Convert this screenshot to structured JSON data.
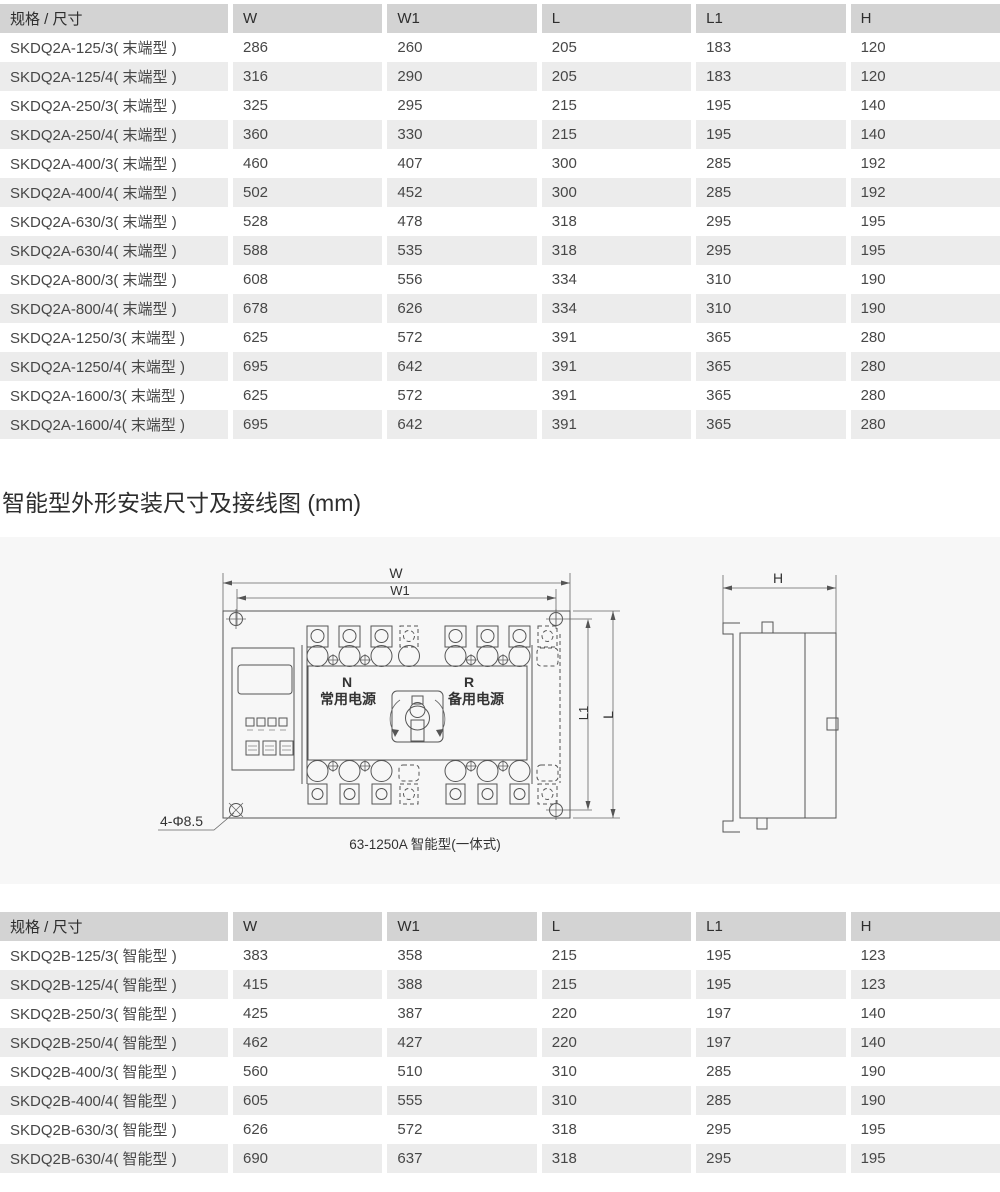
{
  "section": {
    "heading": "智能型外形安装尺寸及接线图 (mm)"
  },
  "tables": {
    "skdq2a": {
      "headers": [
        "规格 / 尺寸",
        "W",
        "W1",
        "L",
        "L1",
        "H"
      ],
      "rows": [
        [
          "SKDQ2A-125/3( 末端型 )",
          "286",
          "260",
          "205",
          "183",
          "120"
        ],
        [
          "SKDQ2A-125/4( 末端型 )",
          "316",
          "290",
          "205",
          "183",
          "120"
        ],
        [
          "SKDQ2A-250/3( 末端型 )",
          "325",
          "295",
          "215",
          "195",
          "140"
        ],
        [
          "SKDQ2A-250/4( 末端型 )",
          "360",
          "330",
          "215",
          "195",
          "140"
        ],
        [
          "SKDQ2A-400/3( 末端型 )",
          "460",
          "407",
          "300",
          "285",
          "192"
        ],
        [
          "SKDQ2A-400/4( 末端型 )",
          "502",
          "452",
          "300",
          "285",
          "192"
        ],
        [
          "SKDQ2A-630/3( 末端型 )",
          "528",
          "478",
          "318",
          "295",
          "195"
        ],
        [
          "SKDQ2A-630/4( 末端型 )",
          "588",
          "535",
          "318",
          "295",
          "195"
        ],
        [
          "SKDQ2A-800/3( 末端型 )",
          "608",
          "556",
          "334",
          "310",
          "190"
        ],
        [
          "SKDQ2A-800/4( 末端型 )",
          "678",
          "626",
          "334",
          "310",
          "190"
        ],
        [
          "SKDQ2A-1250/3( 末端型 )",
          "625",
          "572",
          "391",
          "365",
          "280"
        ],
        [
          "SKDQ2A-1250/4( 末端型 )",
          "695",
          "642",
          "391",
          "365",
          "280"
        ],
        [
          "SKDQ2A-1600/3( 末端型 )",
          "625",
          "572",
          "391",
          "365",
          "280"
        ],
        [
          "SKDQ2A-1600/4( 末端型 )",
          "695",
          "642",
          "391",
          "365",
          "280"
        ]
      ]
    },
    "skdq2b": {
      "headers": [
        "规格 / 尺寸",
        "W",
        "W1",
        "L",
        "L1",
        "H"
      ],
      "rows": [
        [
          "SKDQ2B-125/3( 智能型 )",
          "383",
          "358",
          "215",
          "195",
          "123"
        ],
        [
          "SKDQ2B-125/4( 智能型 )",
          "415",
          "388",
          "215",
          "195",
          "123"
        ],
        [
          "SKDQ2B-250/3( 智能型 )",
          "425",
          "387",
          "220",
          "197",
          "140"
        ],
        [
          "SKDQ2B-250/4( 智能型 )",
          "462",
          "427",
          "220",
          "197",
          "140"
        ],
        [
          "SKDQ2B-400/3( 智能型 )",
          "560",
          "510",
          "310",
          "285",
          "190"
        ],
        [
          "SKDQ2B-400/4( 智能型 )",
          "605",
          "555",
          "310",
          "285",
          "190"
        ],
        [
          "SKDQ2B-630/3( 智能型 )",
          "626",
          "572",
          "318",
          "295",
          "195"
        ],
        [
          "SKDQ2B-630/4( 智能型 )",
          "690",
          "637",
          "318",
          "295",
          "195"
        ]
      ]
    }
  },
  "diagram": {
    "dims": {
      "w": "W",
      "w1": "W1",
      "l": "L",
      "l1": "L1",
      "h": "H"
    },
    "labels": {
      "n": "N",
      "n_source": "常用电源",
      "r": "R",
      "r_source": "备用电源",
      "holes": "4-Φ8.5",
      "caption": "63-1250A 智能型(一体式)"
    }
  },
  "colors": {
    "table_header_bg": "#d3d3d3",
    "row_stripe": "#ececec",
    "diagram_bg": "#f7f7f7",
    "line": "#555555"
  }
}
